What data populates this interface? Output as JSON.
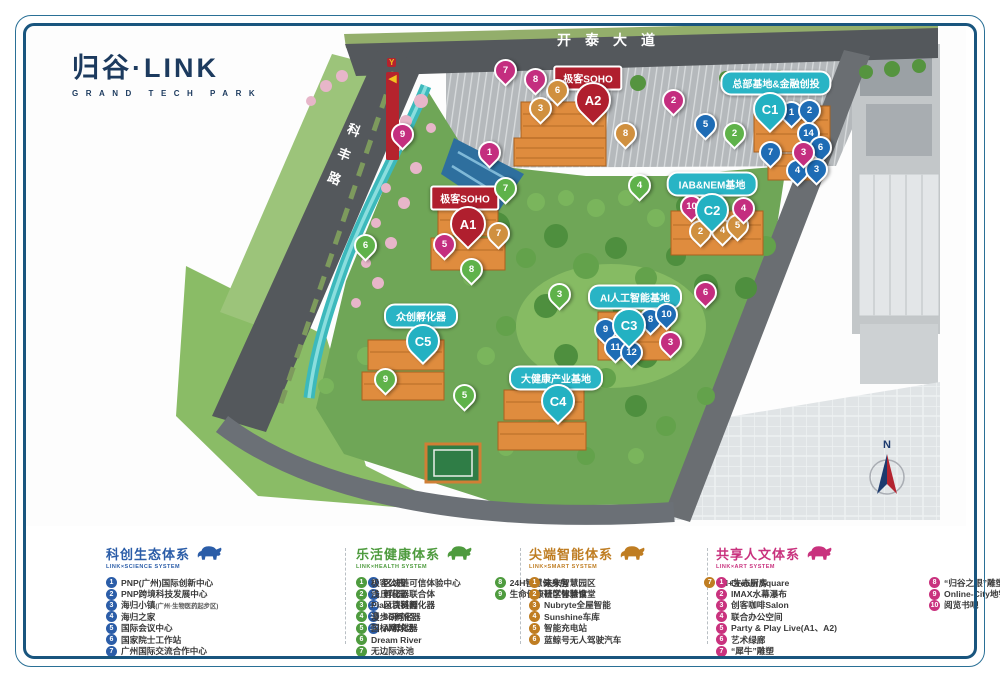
{
  "brand": {
    "title": "归谷·LINK",
    "subtitle": "GRAND TECH PARK"
  },
  "map": {
    "roads": {
      "top": "开泰大道",
      "left_chars": [
        "科",
        "丰",
        "路"
      ]
    },
    "north_label": "N",
    "totem_arrow": "◀",
    "area_labels": [
      {
        "text": "总部基地&金融创投",
        "x": 776,
        "y": 83,
        "style": "teal"
      },
      {
        "text": "IAB&NEM基地",
        "x": 712,
        "y": 184,
        "style": "teal"
      },
      {
        "text": "AI人工智能基地",
        "x": 635,
        "y": 297,
        "style": "teal"
      },
      {
        "text": "大健康产业基地",
        "x": 556,
        "y": 378,
        "style": "teal"
      },
      {
        "text": "众创孵化器",
        "x": 421,
        "y": 316,
        "style": "teal"
      },
      {
        "text": "极客SOHO",
        "x": 588,
        "y": 78,
        "style": "red"
      },
      {
        "text": "极客SOHO",
        "x": 465,
        "y": 198,
        "style": "red"
      }
    ],
    "markers": [
      {
        "t": "C1",
        "c": "base",
        "x": 768,
        "y": 107
      },
      {
        "t": "C2",
        "c": "base",
        "x": 710,
        "y": 208
      },
      {
        "t": "C3",
        "c": "base",
        "x": 627,
        "y": 323
      },
      {
        "t": "C4",
        "c": "base",
        "x": 556,
        "y": 399
      },
      {
        "t": "C5",
        "c": "base",
        "x": 421,
        "y": 339
      },
      {
        "t": "A1",
        "c": "soho",
        "x": 466,
        "y": 222
      },
      {
        "t": "A2",
        "c": "soho",
        "x": 591,
        "y": 98
      },
      {
        "t": "1",
        "c": "science",
        "x": 789,
        "y": 110
      },
      {
        "t": "2",
        "c": "science",
        "x": 807,
        "y": 108
      },
      {
        "t": "14",
        "c": "science",
        "x": 806,
        "y": 131
      },
      {
        "t": "7",
        "c": "science",
        "x": 768,
        "y": 150
      },
      {
        "t": "6",
        "c": "science",
        "x": 818,
        "y": 145
      },
      {
        "t": "4",
        "c": "science",
        "x": 795,
        "y": 168
      },
      {
        "t": "3",
        "c": "science",
        "x": 814,
        "y": 167
      },
      {
        "t": "5",
        "c": "science",
        "x": 703,
        "y": 122
      },
      {
        "t": "9",
        "c": "science",
        "x": 603,
        "y": 327
      },
      {
        "t": "8",
        "c": "science",
        "x": 648,
        "y": 317
      },
      {
        "t": "10",
        "c": "science",
        "x": 664,
        "y": 312
      },
      {
        "t": "11",
        "c": "science",
        "x": 613,
        "y": 345
      },
      {
        "t": "12",
        "c": "science",
        "x": 629,
        "y": 350
      },
      {
        "t": "2",
        "c": "health",
        "x": 732,
        "y": 131
      },
      {
        "t": "4",
        "c": "health",
        "x": 637,
        "y": 183
      },
      {
        "t": "7",
        "c": "health",
        "x": 503,
        "y": 186
      },
      {
        "t": "8",
        "c": "health",
        "x": 469,
        "y": 267
      },
      {
        "t": "3",
        "c": "health",
        "x": 557,
        "y": 292
      },
      {
        "t": "9",
        "c": "health",
        "x": 383,
        "y": 377
      },
      {
        "t": "5",
        "c": "health",
        "x": 462,
        "y": 393
      },
      {
        "t": "6",
        "c": "health",
        "x": 363,
        "y": 243
      },
      {
        "t": "6",
        "c": "smart",
        "x": 555,
        "y": 88
      },
      {
        "t": "3",
        "c": "smart",
        "x": 538,
        "y": 106
      },
      {
        "t": "8",
        "c": "smart",
        "x": 623,
        "y": 131
      },
      {
        "t": "2",
        "c": "smart",
        "x": 698,
        "y": 229
      },
      {
        "t": "4",
        "c": "smart",
        "x": 720,
        "y": 228
      },
      {
        "t": "5",
        "c": "smart",
        "x": 735,
        "y": 223
      },
      {
        "t": "7",
        "c": "smart",
        "x": 496,
        "y": 231
      },
      {
        "t": "7",
        "c": "art",
        "x": 503,
        "y": 68
      },
      {
        "t": "8",
        "c": "art",
        "x": 533,
        "y": 77
      },
      {
        "t": "2",
        "c": "art",
        "x": 671,
        "y": 98
      },
      {
        "t": "9",
        "c": "art",
        "x": 400,
        "y": 132
      },
      {
        "t": "1",
        "c": "art",
        "x": 487,
        "y": 150
      },
      {
        "t": "3",
        "c": "art",
        "x": 801,
        "y": 150
      },
      {
        "t": "10",
        "c": "art",
        "x": 689,
        "y": 204
      },
      {
        "t": "4",
        "c": "art",
        "x": 741,
        "y": 206
      },
      {
        "t": "5",
        "c": "art",
        "x": 442,
        "y": 242
      },
      {
        "t": "6",
        "c": "art",
        "x": 703,
        "y": 290
      },
      {
        "t": "3",
        "c": "art",
        "x": 668,
        "y": 340
      }
    ]
  },
  "legend": {
    "sections": [
      {
        "title": "科创生态体系",
        "subtitle": "LINK×SCIENCE SYSTEM",
        "color": "#2b5da8",
        "x": 106,
        "col2_offset": 150,
        "col1": [
          {
            "n": "1",
            "text": "PNP(广州)国际创新中心"
          },
          {
            "n": "2",
            "text": "PNP跨境科技发展中心"
          },
          {
            "n": "3",
            "text": "海归小镇",
            "sub": "(广州·生物医药起步区)"
          },
          {
            "n": "4",
            "text": "海归之家"
          },
          {
            "n": "5",
            "text": "国际会议中心"
          },
          {
            "n": "6",
            "text": "国家院士工作站"
          },
          {
            "n": "7",
            "text": "广州国际交流合作中心"
          }
        ],
        "col2": [
          {
            "n": "8",
            "text": "区块链可信体验中心"
          },
          {
            "n": "9",
            "text": "孵化器联合体"
          },
          {
            "n": "10",
            "text": "区块链孵化器"
          },
          {
            "n": "11",
            "text": "5G孵化器"
          },
          {
            "n": "12",
            "text": "AI孵化器"
          }
        ]
      },
      {
        "title": "乐活健康体系",
        "subtitle": "LINK×HEALTH SYSTEM",
        "color": "#4e9b3e",
        "x": 356,
        "col2_offset": 73,
        "col1": [
          {
            "n": "1",
            "text": "极客公园"
          },
          {
            "n": "2",
            "text": "浅丘花园"
          },
          {
            "n": "3",
            "text": "Plant百科园"
          },
          {
            "n": "4",
            "text": "漫步研习径"
          },
          {
            "n": "5",
            "text": "国标网球场"
          },
          {
            "n": "6",
            "text": "Dream River"
          },
          {
            "n": "7",
            "text": "无边际泳池"
          }
        ],
        "col2": [
          {
            "n": "8",
            "text": "24H智慧健身房"
          },
          {
            "n": "9",
            "text": "生命健康研学体验馆"
          }
        ]
      },
      {
        "title": "尖端智能体系",
        "subtitle": "LINK×SMART SYSTEM",
        "color": "#bf7d22",
        "x": 529,
        "col2_offset": 83,
        "col1": [
          {
            "n": "1",
            "text": "未来智慧园区"
          },
          {
            "n": "2",
            "text": "社区智慧食堂"
          },
          {
            "n": "3",
            "text": "Nubryte全屋智能"
          },
          {
            "n": "4",
            "text": "Sunshine车库"
          },
          {
            "n": "5",
            "text": "智能充电站"
          },
          {
            "n": "6",
            "text": "蓝鲸号无人驾驶汽车"
          }
        ],
        "col2": [
          {
            "n": "7",
            "text": "AI+生态厨房"
          }
        ]
      },
      {
        "title": "共享人文体系",
        "subtitle": "LINK×ART SYSTEM",
        "color": "#c9327e",
        "x": 716,
        "col2_offset": 92,
        "col1": [
          {
            "n": "1",
            "text": "Dream Square"
          },
          {
            "n": "2",
            "text": "IMAX水幕瀑布"
          },
          {
            "n": "3",
            "text": "创客咖啡Salon"
          },
          {
            "n": "4",
            "text": "联合办公空间"
          },
          {
            "n": "5",
            "text": "Party & Play Live(A1、A2)"
          },
          {
            "n": "6",
            "text": "艺术绿廊"
          },
          {
            "n": "7",
            "text": "“犀牛”雕塑"
          }
        ],
        "col2": [
          {
            "n": "8",
            "text": "“归谷之眼”雕塑"
          },
          {
            "n": "9",
            "text": "Online-City地铁出行"
          },
          {
            "n": "10",
            "text": "阅览书吧"
          }
        ]
      }
    ],
    "separators_x": [
      345,
      520,
      707
    ]
  },
  "colors": {
    "pin": {
      "science": "#1e6cb5",
      "health": "#5fb24a",
      "smart": "#d0903f",
      "art": "#c42e7f",
      "base": "#23b1c2",
      "soho": "#b01f2e"
    },
    "frame": "#19557e",
    "brand_navy": "#1c3a5e",
    "teal_label": "#29b4c5",
    "red_label": "#b01f2e"
  }
}
